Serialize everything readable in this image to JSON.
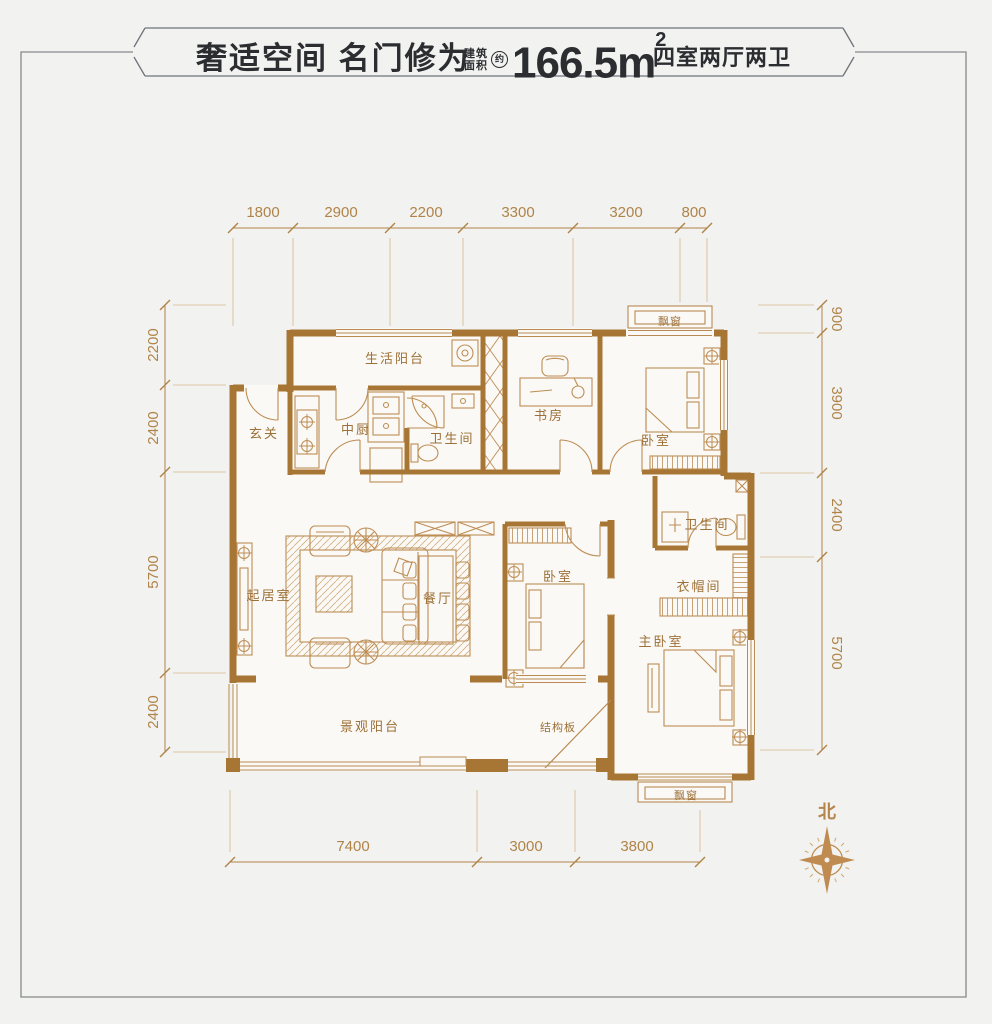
{
  "header": {
    "title": "奢适空间 名门修为",
    "area_prefix_top": "建筑",
    "area_prefix_bottom": "面积",
    "area_approx": "约",
    "area_value": "166.5",
    "area_unit": "m",
    "area_exponent": "2",
    "layout_summary": "四室两厅两卫"
  },
  "plan": {
    "rooms": [
      {
        "label": "玄关"
      },
      {
        "label": "生活阳台"
      },
      {
        "label": "中厨"
      },
      {
        "label": "卫生间"
      },
      {
        "label": "书房"
      },
      {
        "label": "卧室"
      },
      {
        "label": "飘窗"
      },
      {
        "label": "起居室"
      },
      {
        "label": "餐厅"
      },
      {
        "label": "卧室"
      },
      {
        "label": "卫生间"
      },
      {
        "label": "衣帽间"
      },
      {
        "label": "主卧室"
      },
      {
        "label": "景观阳台"
      },
      {
        "label": "结构板"
      },
      {
        "label": "飘窗"
      }
    ],
    "dimensions": {
      "top": [
        "1800",
        "2900",
        "2200",
        "3300",
        "3200",
        "800"
      ],
      "left": [
        "2200",
        "2400",
        "5700",
        "2400"
      ],
      "right": [
        "900",
        "3900",
        "2400",
        "5700"
      ],
      "bottom": [
        "7400",
        "3000",
        "3800"
      ]
    },
    "compass_label": "北"
  },
  "colors": {
    "wall": "#a87634",
    "furniture_line": "#bd8d55",
    "dimension_text": "#b08449",
    "room_label_text": "#9c7038",
    "title_text": "#2b2d31",
    "frame_line": "#85898d",
    "background": "#f2f2f0",
    "floor": "#fbf9f5"
  }
}
